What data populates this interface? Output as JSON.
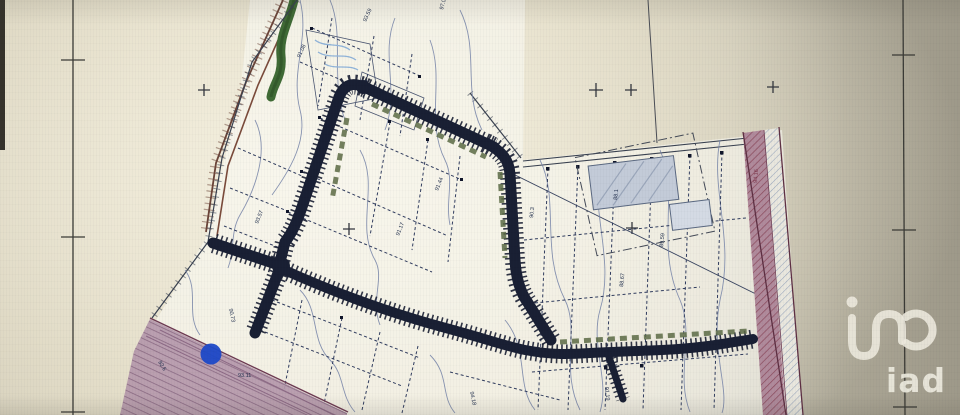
{
  "logo": {
    "label": "iad",
    "icon": "iad-monogram-icon",
    "color": "#ece9dd"
  },
  "marker": {
    "name": "blue-location-dot",
    "color": "#1d49c8"
  },
  "plan": {
    "type": "land-subdivision-site-plan-photo",
    "elevation_labels": [
      {
        "text": "93.59"
      },
      {
        "text": "97.06"
      },
      {
        "text": "91.08"
      },
      {
        "text": "93.57"
      },
      {
        "text": "91.44"
      },
      {
        "text": "91.17"
      },
      {
        "text": "90.3"
      },
      {
        "text": "88.1"
      },
      {
        "text": "88.67"
      },
      {
        "text": "89.59"
      },
      {
        "text": "90.73"
      },
      {
        "text": "93.11"
      },
      {
        "text": "92.6"
      },
      {
        "text": "94.16"
      },
      {
        "text": "91.19"
      },
      {
        "text": "94.18"
      }
    ],
    "colors": {
      "paper": "#ddd7c2",
      "road": "#191f33",
      "contour": "#7583a8",
      "plot_line": "#303c5e",
      "existing_road_fill": "#b598ab",
      "existing_road_edge": "#6d3a52",
      "vegetation": "#3f6a35",
      "old_road": "#6b4438",
      "hedge": "#5c6b45",
      "building_fill": "#c3cbd8",
      "marker_blue": "#1d49c8"
    }
  }
}
